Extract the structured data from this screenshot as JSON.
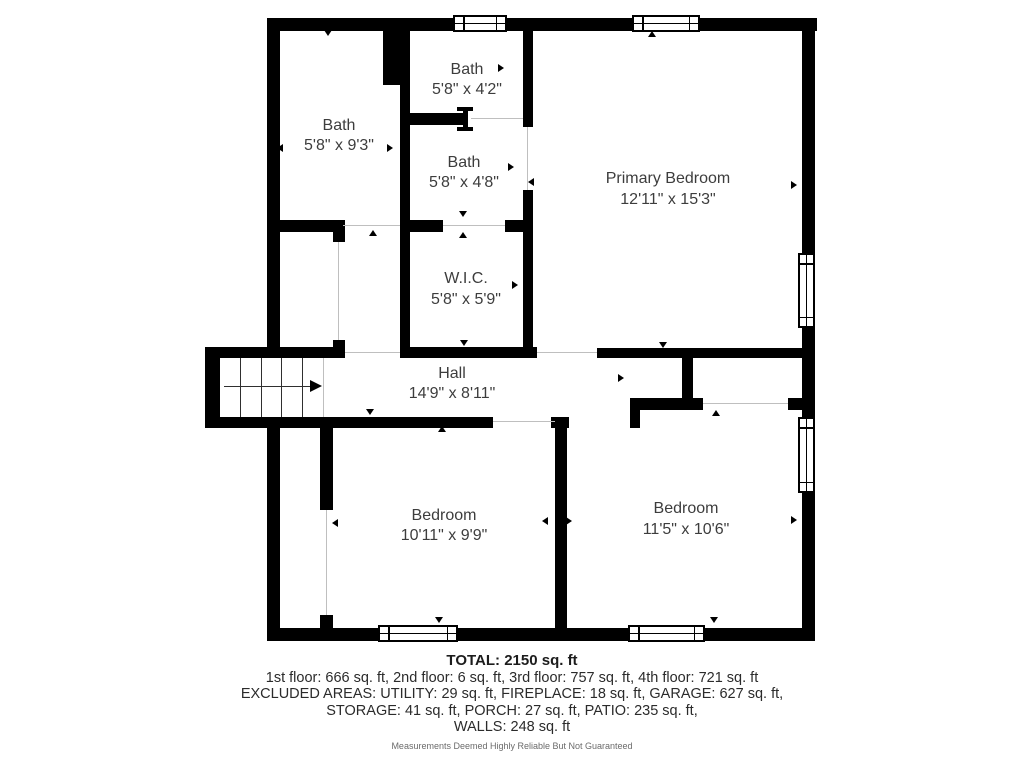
{
  "floor_plan": {
    "rooms": [
      {
        "name": "Bath",
        "dims": "5'8\" x 9'3\""
      },
      {
        "name": "Bath",
        "dims": "5'8\" x 4'2\""
      },
      {
        "name": "Bath",
        "dims": "5'8\" x 4'8\""
      },
      {
        "name": "Primary Bedroom",
        "dims": "12'11\" x 15'3\""
      },
      {
        "name": "W.I.C.",
        "dims": "5'8\" x 5'9\""
      },
      {
        "name": "Hall",
        "dims": "14'9\" x 8'11\""
      },
      {
        "name": "Bedroom",
        "dims": "10'11\" x 9'9\""
      },
      {
        "name": "Bedroom",
        "dims": "11'5\" x 10'6\""
      }
    ],
    "icons": {
      "window": "window-symbol",
      "stairs": "staircase-symbol",
      "arrow": "arrow-marker"
    },
    "colors": {
      "wall": "#000000",
      "room_text": "#3d3d3d",
      "threshold_line": "#bfbfbf",
      "footer_text": "#2b2b2b",
      "disclaimer_text": "#6b6b6b"
    }
  },
  "footer": {
    "total": "TOTAL: 2150 sq. ft",
    "floors": "1st floor: 666 sq. ft, 2nd floor: 6 sq. ft, 3rd floor: 757 sq. ft, 4th floor: 721 sq. ft",
    "excluded_1": "EXCLUDED AREAS: UTILITY: 29 sq. ft, FIREPLACE: 18 sq. ft, GARAGE: 627 sq. ft,",
    "excluded_2": "STORAGE: 41 sq. ft, PORCH: 27 sq. ft, PATIO: 235 sq. ft,",
    "excluded_3": "WALLS: 248 sq. ft",
    "disclaimer": "Measurements Deemed Highly Reliable But Not Guaranteed"
  }
}
